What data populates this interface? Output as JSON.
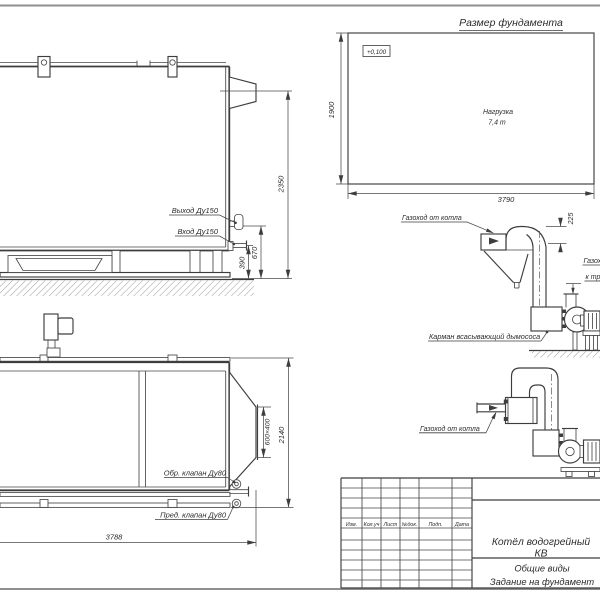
{
  "foundation": {
    "title": "Размер фундамента",
    "elevation_mark": "+0,100",
    "load_line1": "Нагрузка",
    "load_line2": "7,4 т",
    "width_dim": "3790",
    "depth_dim": "1900"
  },
  "front_view": {
    "outlet_label": "Выход Ду150",
    "inlet_label": "Вход Ду150",
    "height_dim": "2350",
    "outlet_height_dim": "670",
    "inlet_height_dim": "390"
  },
  "plan_view": {
    "check_valve_label": "Обр. клапан Ду80",
    "safety_valve_label": "Пред. клапан Ду80",
    "length_dim": "3788",
    "width_dim": "2140",
    "flue_outlet_dim": "600×400"
  },
  "flue_upper": {
    "from_boiler_label": "Газоход от котла",
    "offset_dim": "225",
    "to_stack_label_line1": "Газоход",
    "to_stack_label_line2": "к трубе",
    "pocket_label": "Карман всасывающий дымососа"
  },
  "flue_lower": {
    "from_boiler_label": "Газоход от котла"
  },
  "title_block": {
    "columns": [
      "Изм.",
      "Кол.уч",
      "Лист",
      "№док.",
      "Подп.",
      "Дата"
    ],
    "product_line1": "Котёл водогрейный",
    "product_line2": "КВ",
    "doc_line1": "Общие виды",
    "doc_line2": "Задание на фундамент"
  }
}
